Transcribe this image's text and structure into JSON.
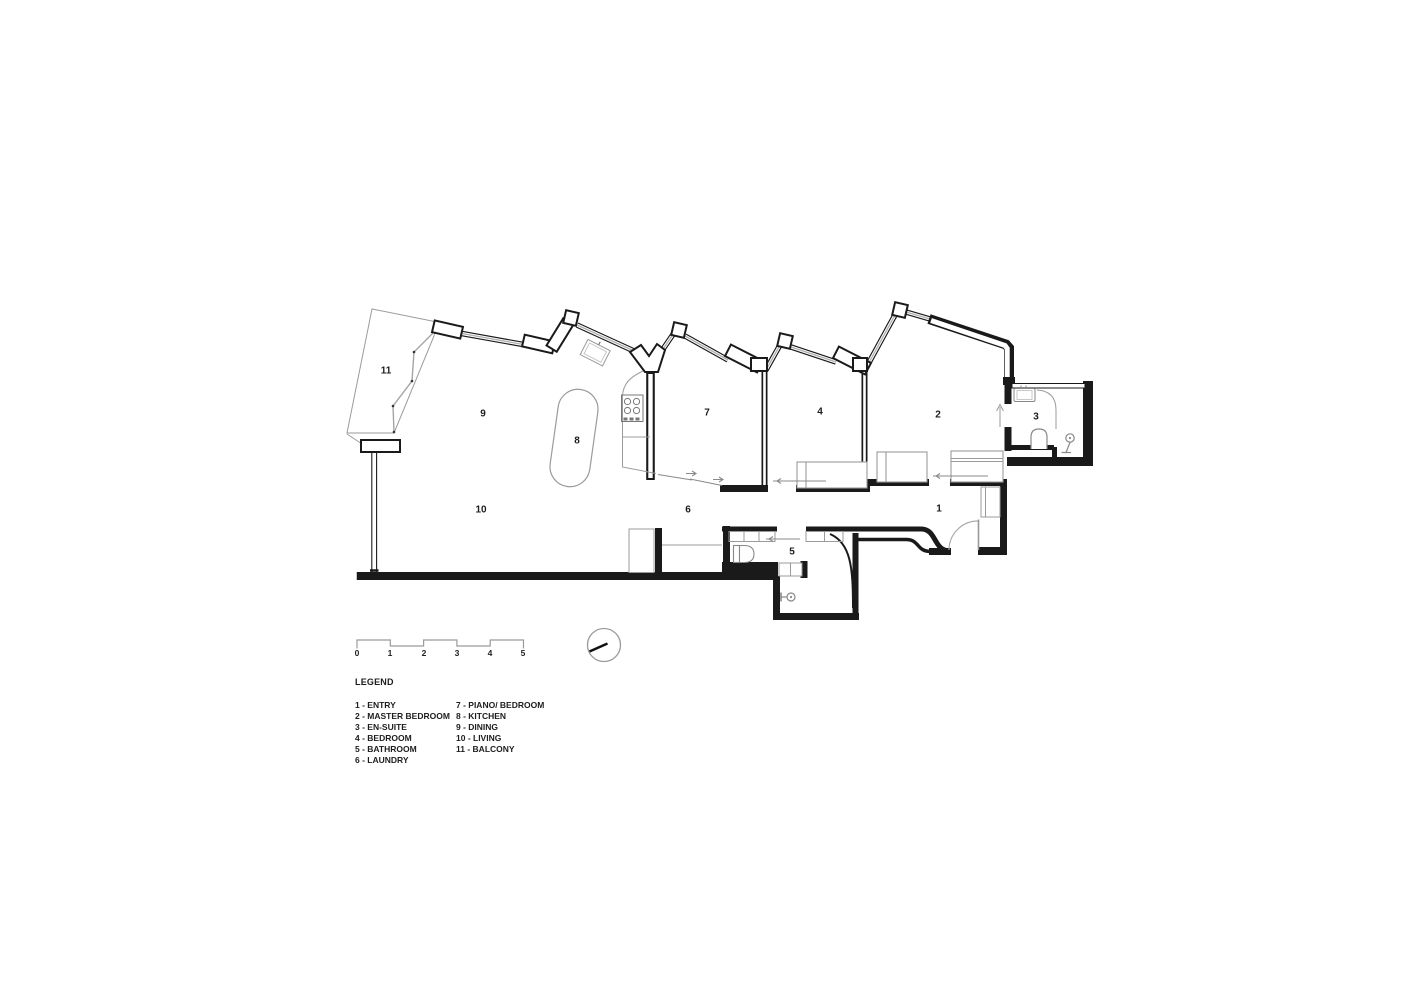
{
  "plan": {
    "room_labels": [
      {
        "number": "1",
        "name": "entry"
      },
      {
        "number": "2",
        "name": "master-bedroom"
      },
      {
        "number": "3",
        "name": "en-suite"
      },
      {
        "number": "4",
        "name": "bedroom"
      },
      {
        "number": "5",
        "name": "bathroom"
      },
      {
        "number": "6",
        "name": "laundry"
      },
      {
        "number": "7",
        "name": "piano-bedroom"
      },
      {
        "number": "8",
        "name": "kitchen"
      },
      {
        "number": "9",
        "name": "dining"
      },
      {
        "number": "10",
        "name": "living"
      },
      {
        "number": "11",
        "name": "balcony"
      }
    ]
  },
  "scale_bar": {
    "ticks": [
      "0",
      "1",
      "2",
      "3",
      "4",
      "5"
    ]
  },
  "legend": {
    "title": "LEGEND",
    "columns": [
      [
        "1 - ENTRY",
        "2 - MASTER BEDROOM",
        "3 - EN-SUITE",
        "4 - BEDROOM",
        "5 - BATHROOM",
        "6 - LAUNDRY"
      ],
      [
        "7 - PIANO/ BEDROOM",
        "8 - KITCHEN",
        "9 - DINING",
        "10 - LIVING",
        "11 - BALCONY"
      ]
    ]
  },
  "colors": {
    "wall": "#1a1a1a",
    "thin_line": "#9b9b9b",
    "text": "#1d1d1d",
    "background": "#ffffff"
  }
}
